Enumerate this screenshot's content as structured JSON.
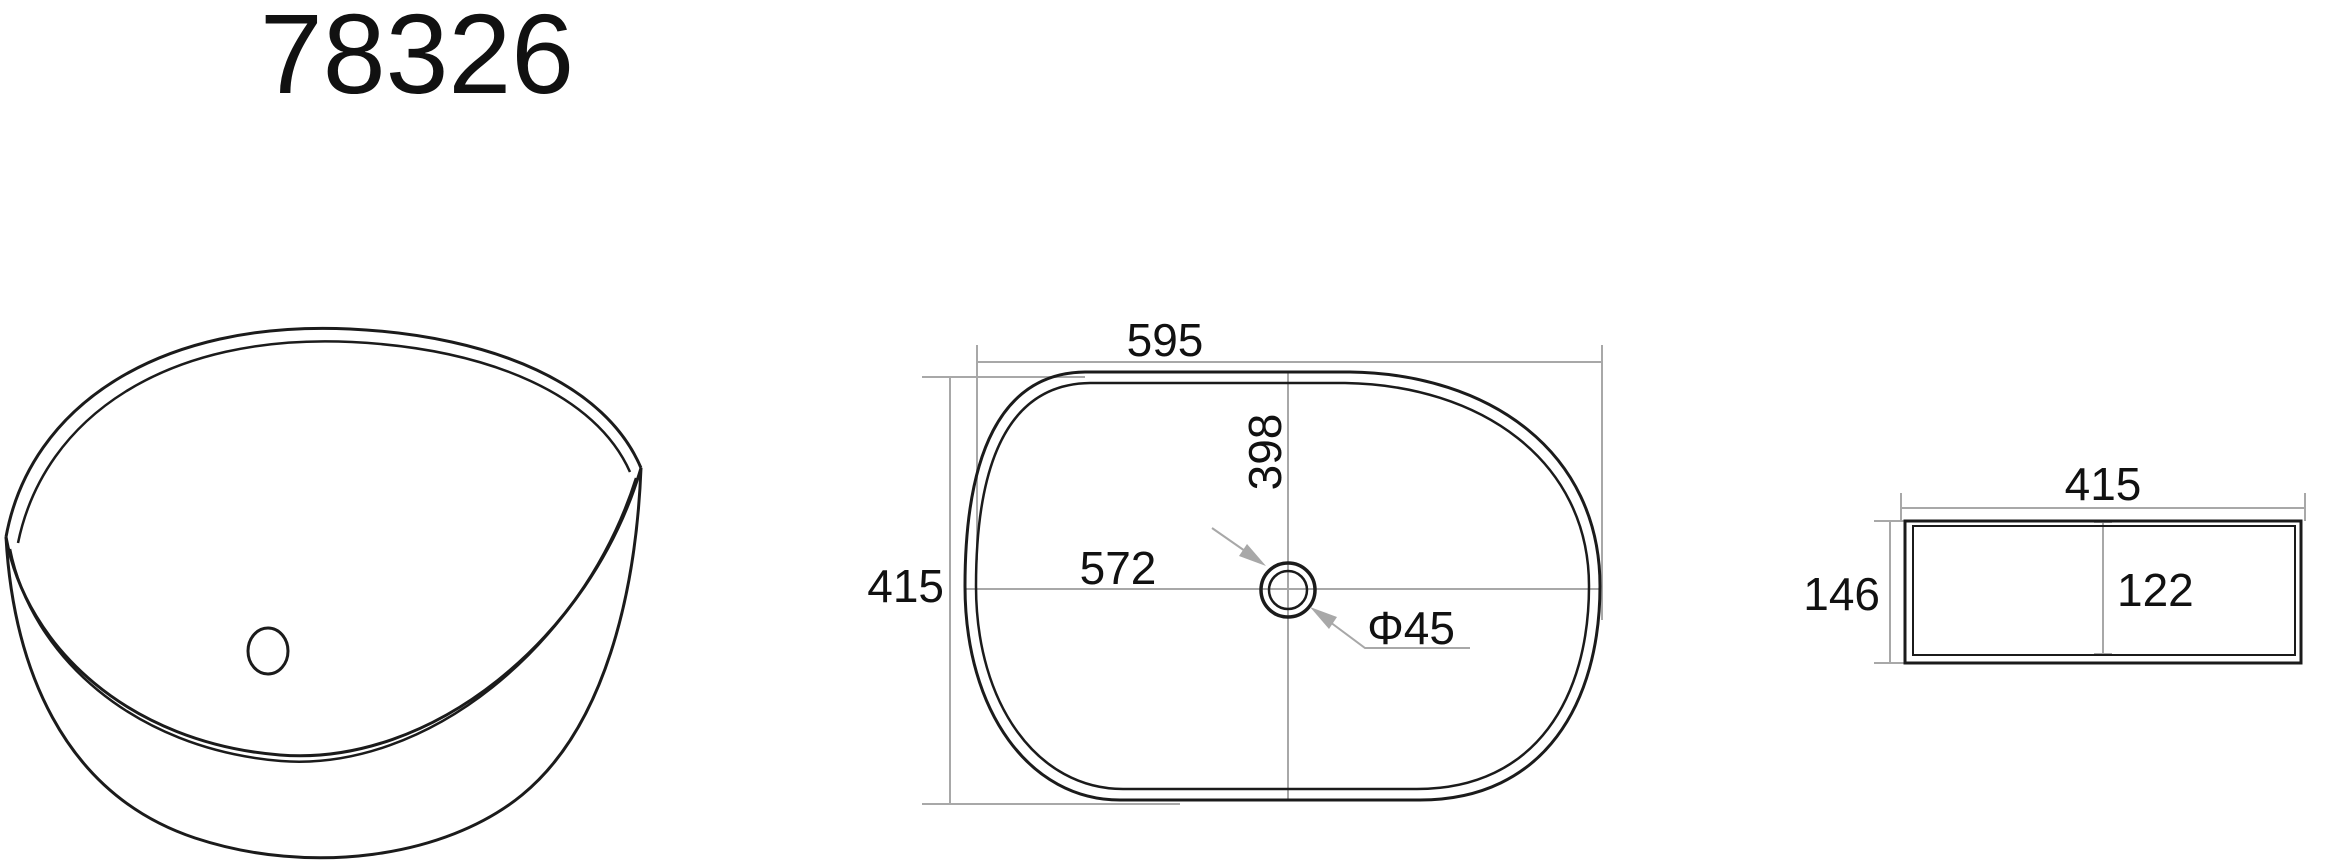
{
  "title": "78326",
  "colors": {
    "object_line": "#1b1b1b",
    "dimension_line": "#a8a8a8",
    "text": "#111111",
    "background": "#ffffff"
  },
  "top_view": {
    "overall_width": "595",
    "overall_depth": "415",
    "basin_length": "572",
    "basin_width": "398",
    "drain_diameter": "Φ45"
  },
  "side_view": {
    "overall_width": "415",
    "overall_height": "146",
    "basin_depth": "122"
  }
}
